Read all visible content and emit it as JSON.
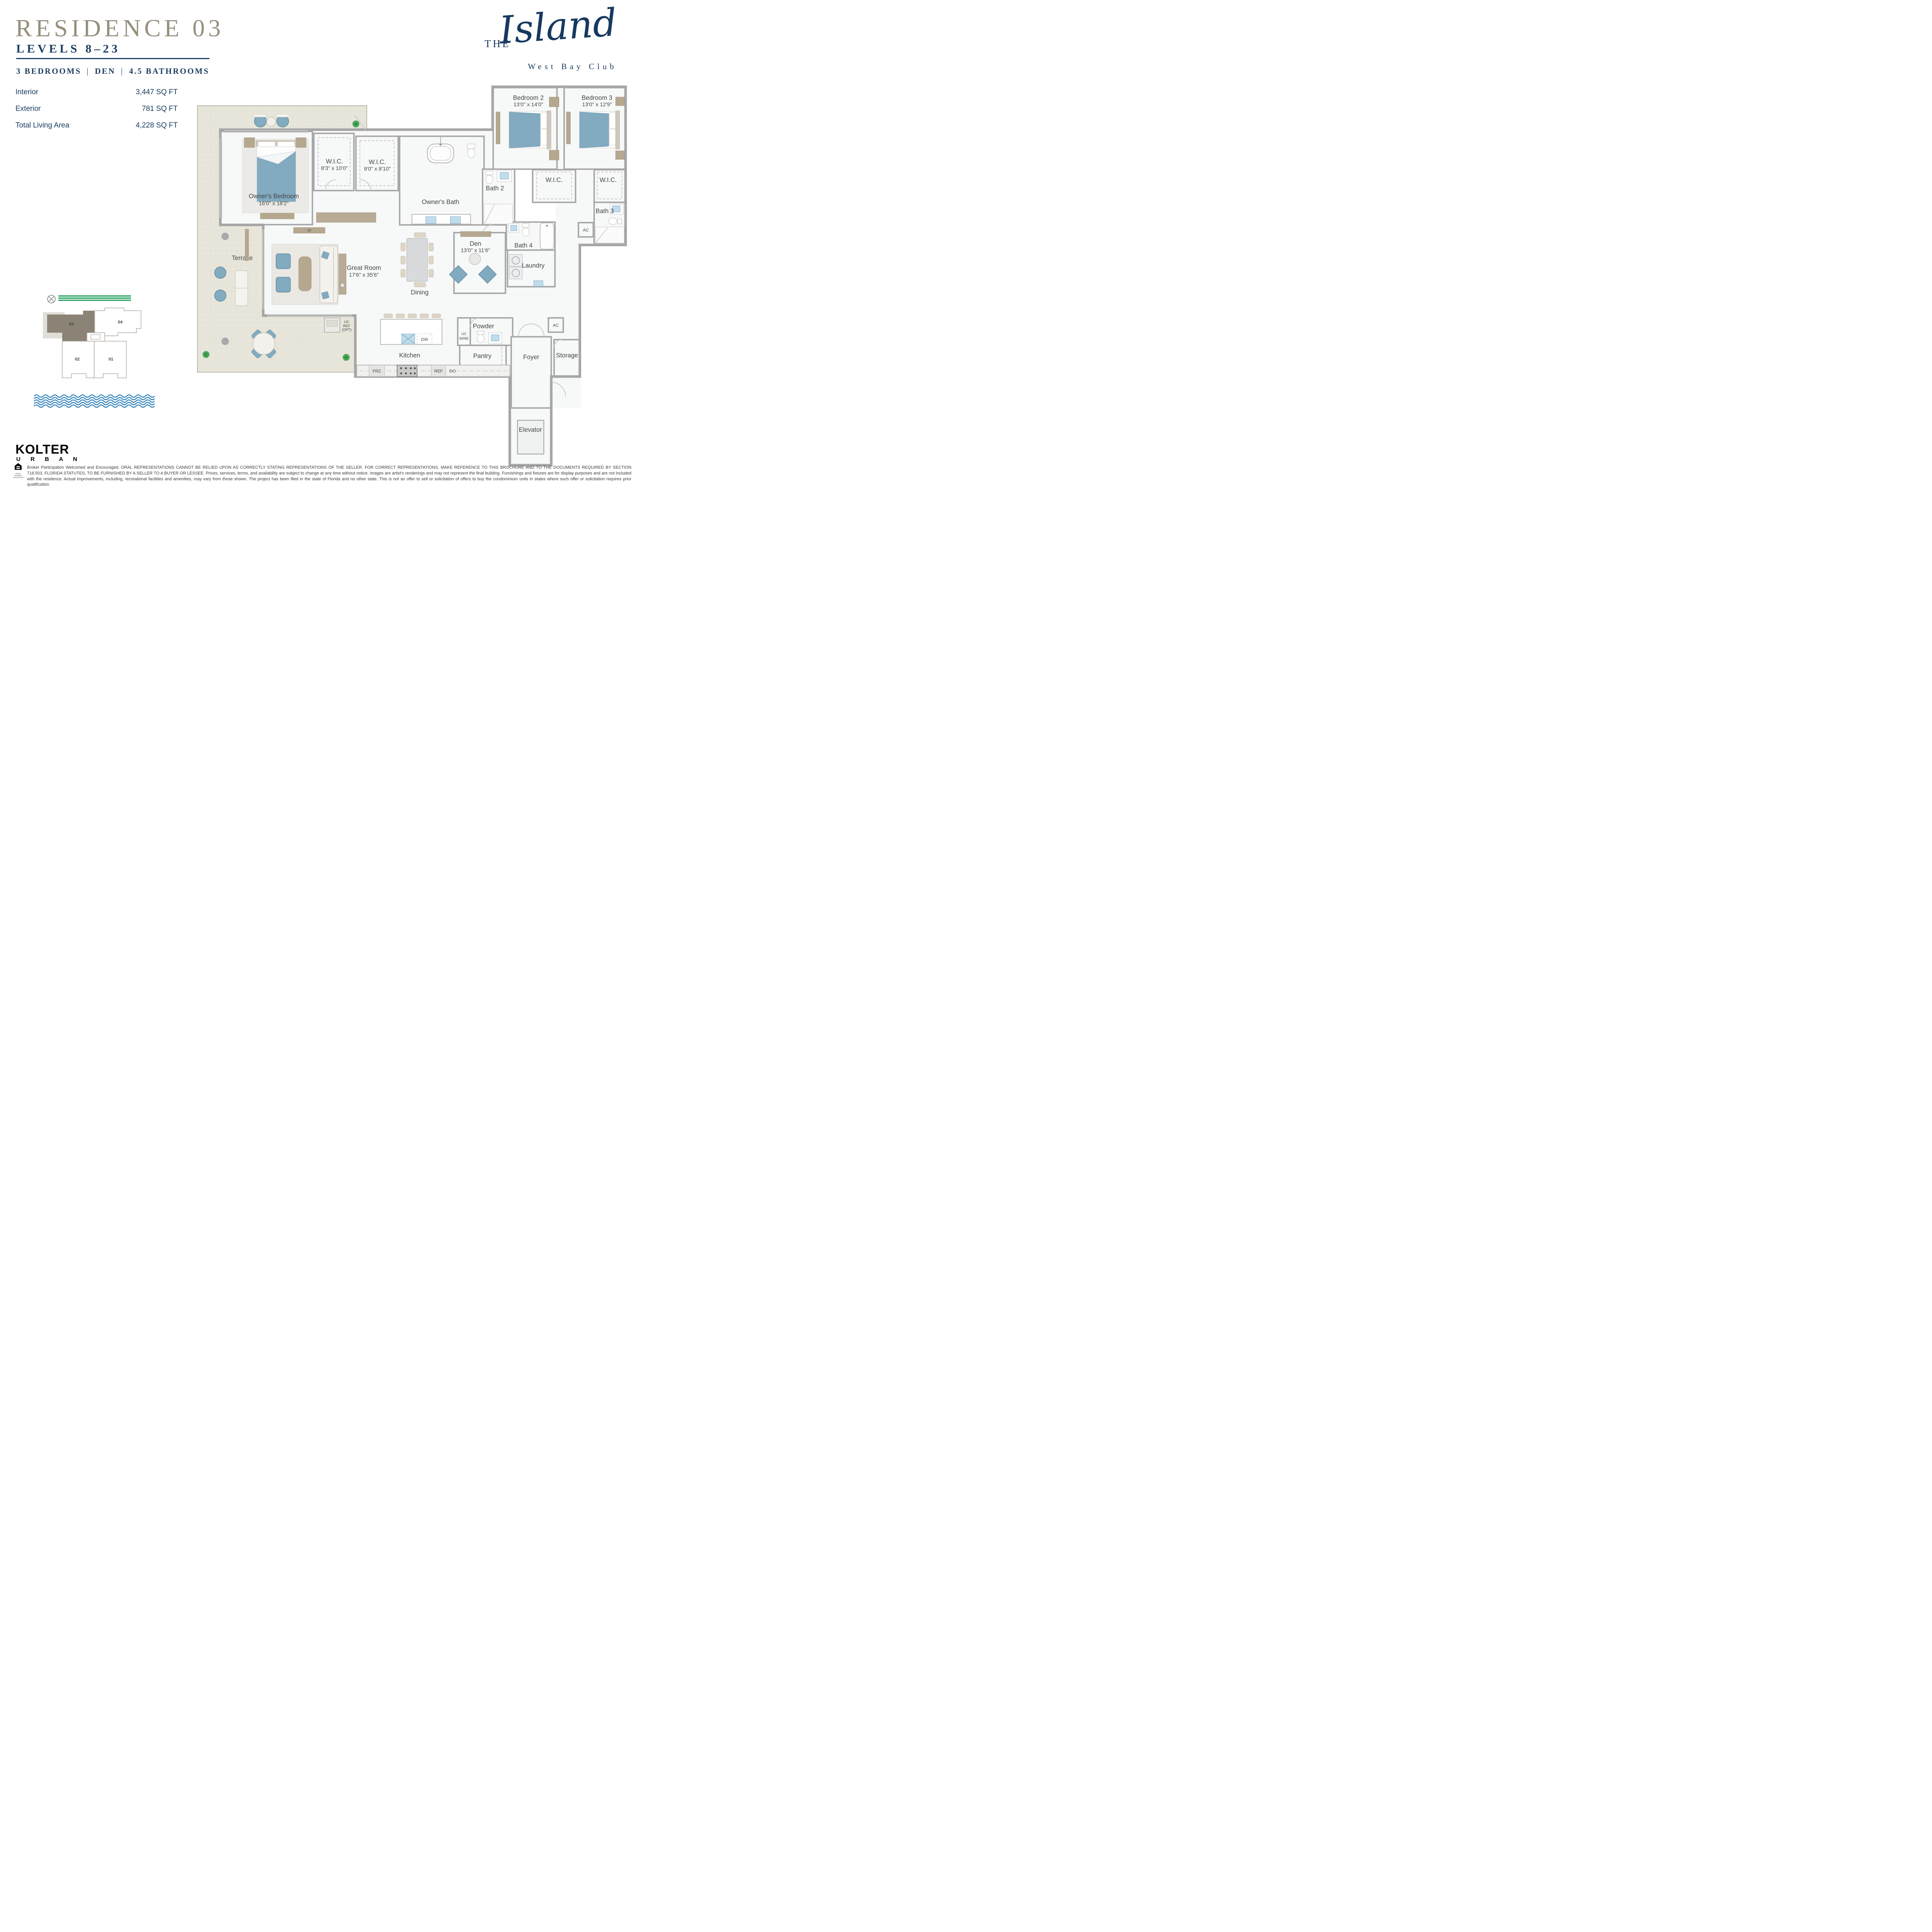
{
  "header": {
    "residence": "RESIDENCE 03",
    "levels": "LEVELS 8–23",
    "feature_bedrooms": "3 BEDROOMS",
    "feature_den": "DEN",
    "feature_baths": "4.5 BATHROOMS",
    "separator": "|"
  },
  "brand": {
    "the": "THE",
    "name": "Island",
    "club": "West Bay Club"
  },
  "stats": {
    "rows": [
      {
        "label": "Interior",
        "value": "3,447 SQ FT"
      },
      {
        "label": "Exterior",
        "value": "781 SQ FT"
      },
      {
        "label": "Total Living Area",
        "value": "4,228 SQ FT"
      }
    ]
  },
  "floorplan": {
    "terrace": "Terrace",
    "owners_bedroom": {
      "name": "Owner's Bedroom",
      "dims": "16'0\" x 18'2\""
    },
    "wic1": {
      "name": "W.I.C.",
      "dims": "8'3\" x 10'0\""
    },
    "wic2": {
      "name": "W.I.C.",
      "dims": "9'0\" x 8'10\""
    },
    "owners_bath": "Owner's Bath",
    "bath2": "Bath 2",
    "bath3": "Bath 3",
    "bath4": "Bath 4",
    "bedroom2": {
      "name": "Bedroom 2",
      "dims": "13'0\" x 14'0\""
    },
    "bedroom3": {
      "name": "Bedroom 3",
      "dims": "13'0\" x 12'9\""
    },
    "wic": "W.I.C.",
    "den": {
      "name": "Den",
      "dims": "13'0\" x 11'6\""
    },
    "laundry": "Laundry",
    "ac": "AC",
    "great_room": {
      "name": "Great Room",
      "dims": "17'6\" x 35'6\""
    },
    "dining": "Dining",
    "kitchen": "Kitchen",
    "powder": "Powder",
    "pantry": "Pantry",
    "foyer": "Foyer",
    "storage": "Storage",
    "elevator": "Elevator",
    "labels": {
      "frz": "FRZ",
      "ref": "REF",
      "dor": "DO",
      "dw": "DW",
      "uc": "UC",
      "wine": "WINE",
      "opt": "(OPT)"
    }
  },
  "keyplan": {
    "u01": "01",
    "u02": "02",
    "u03": "03",
    "u04": "04"
  },
  "footer": {
    "kolter": "KOLTER",
    "urban": "U R B A N",
    "eho": "EQUAL HOUSING OPPORTUNITY",
    "disclaimer": "Broker Participation Welcomed and Encouraged. ORAL REPRESENTATIONS CANNOT BE RELIED UPON AS CORRECTLY STATING REPRESENTATIONS OF THE SELLER. FOR CORRECT REPRESENTATIONS, MAKE REFERENCE TO THIS BROCHURE AND TO THE DOCUMENTS REQUIRED BY SECTION 718.503, FLORIDA STATUTES, TO BE FURNISHED BY A SELLER TO A BUYER OR LESSEE. Prices, services, terms, and availability are subject to change at any time without notice. Images are artist's renderings and may not represent the final building. Furnishings and fixtures are for display purposes and are not included with the residence. Actual improvements, including, recreational facilities and amenities, may vary from those shown. The project has been filed in the state of Florida and no other state. This is not an offer to sell or solicitation of offers to buy the condominium units in states where such offer or solicitation requires prior qualification."
  }
}
